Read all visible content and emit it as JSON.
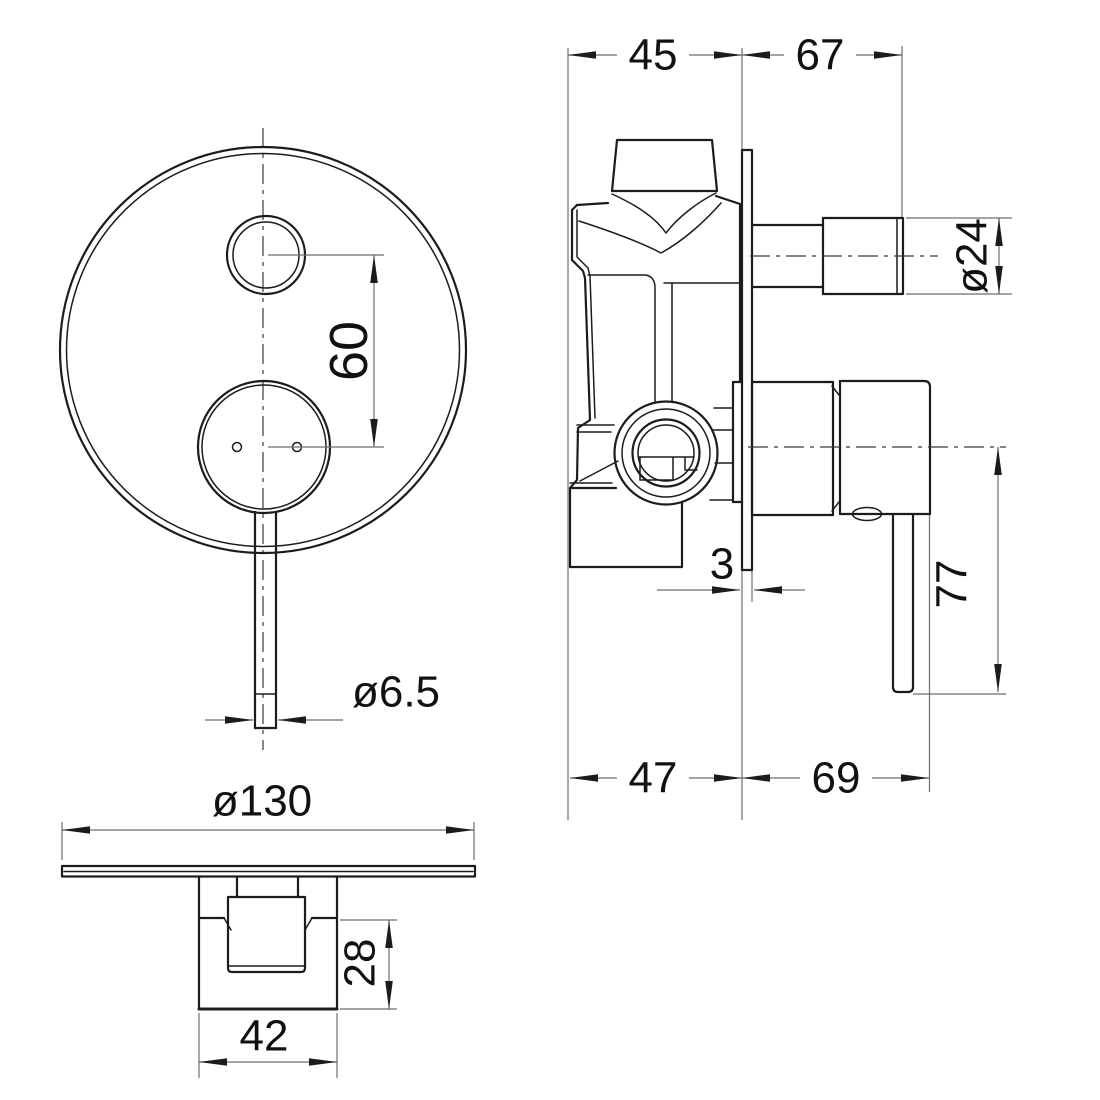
{
  "drawing": {
    "kind": "technical dimension drawing, concealed shower mixer valve, 3 orthographic views",
    "background": "#ffffff",
    "line_color": "#1c1c1c",
    "dim_line_color": "#6e6e6e",
    "text_color": "#111111"
  },
  "views": {
    "front_view": {
      "label": "front view",
      "dims": {
        "button_to_handle_spacing": "60",
        "lever_rod_diameter": "ø6.5"
      }
    },
    "side_view": {
      "label": "side view",
      "dims": {
        "rough_in_depth_top": "45",
        "trim_projection_top": "67",
        "outlet_pipe_diameter": "ø24",
        "plate_thickness": "3",
        "lever_drop_length": "77",
        "rough_in_depth_bottom": "47",
        "trim_projection_bottom": "69"
      }
    },
    "bottom_view": {
      "label": "bottom view",
      "dims": {
        "plate_diameter": "ø130",
        "handle_body_height": "28",
        "handle_body_width": "42"
      }
    }
  }
}
